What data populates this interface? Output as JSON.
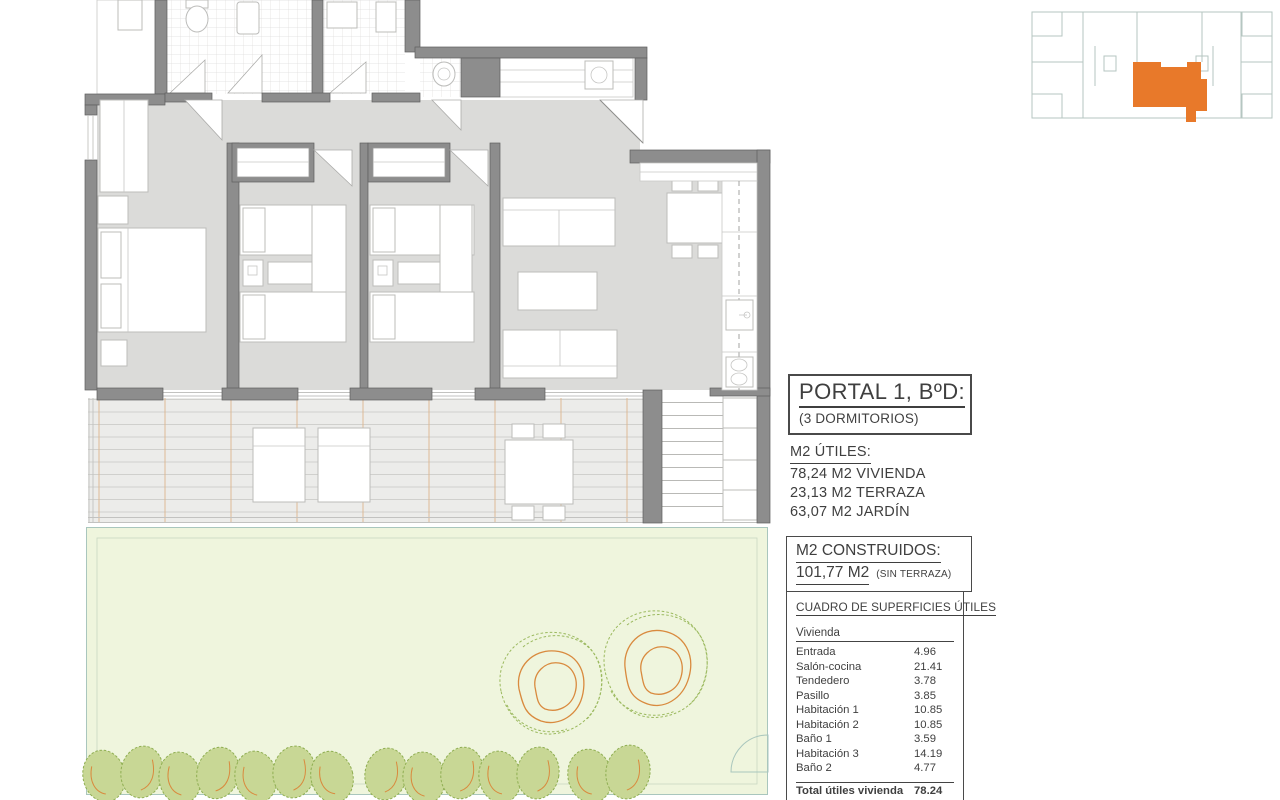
{
  "portal_box": {
    "title": "PORTAL 1, BºD:",
    "subtitle": "(3 DORMITORIOS)"
  },
  "m2_utiles": {
    "heading": "M2 ÚTILES:",
    "lines": [
      "78,24 M2 VIVIENDA",
      "23,13 M2 TERRAZA",
      "63,07 M2 JARDÍN"
    ]
  },
  "m2_construidos": {
    "heading": "M2 CONSTRUIDOS:",
    "value": "101,77 M2",
    "note": "(SIN TERRAZA)"
  },
  "surface_table": {
    "title": "CUADRO DE SUPERFICIES ÚTILES",
    "group_header": "Vivienda",
    "rows": [
      {
        "label": "Entrada",
        "value": "4.96"
      },
      {
        "label": "Salón-cocina",
        "value": "21.41"
      },
      {
        "label": "Tendedero",
        "value": "3.78"
      },
      {
        "label": "Pasillo",
        "value": "3.85"
      },
      {
        "label": "Habitación 1",
        "value": "10.85"
      },
      {
        "label": "Habitación 2",
        "value": "10.85"
      },
      {
        "label": "Baño 1",
        "value": "3.59"
      },
      {
        "label": "Habitación 3",
        "value": "14.19"
      },
      {
        "label": "Baño 2",
        "value": "4.77"
      }
    ],
    "total": {
      "label": "Total útiles vivienda",
      "value": "78.24"
    }
  },
  "colors": {
    "accent_orange": "#E8792A",
    "wall_gray": "#8D8D8D",
    "floor_gray": "#DBDBD9",
    "garden_green": "#EFF5DD",
    "tree_green": "#9BB95E",
    "tree_orange": "#D98A3E",
    "minimap_line": "#B5C6C1",
    "terrace_joint": "#DDB58E"
  }
}
